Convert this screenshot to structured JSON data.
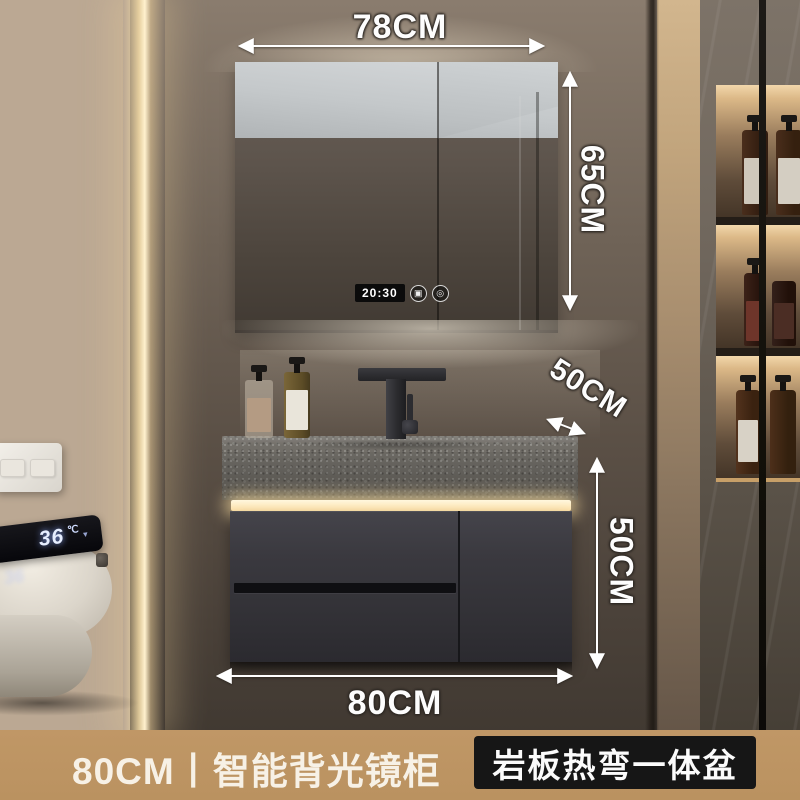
{
  "product_annotations": {
    "mirror_width": "78CM",
    "mirror_height": "65CM",
    "counter_depth": "50CM",
    "cabinet_height": "50CM",
    "cabinet_width": "80CM"
  },
  "mirror_display": {
    "time": "20:30",
    "defog_icon_glyph": "▣",
    "power_icon_glyph": "◎"
  },
  "toilet_display": {
    "temperature": "36",
    "unit": "℃",
    "chevron_glyph": "▾"
  },
  "banner": {
    "left_text": "80CM丨智能背光镜柜",
    "right_text": "岩板热弯一体盆",
    "bg_color": "#bd9563",
    "right_box_bg_color": "#161616",
    "text_color": "#f7f1e6"
  },
  "scene_colors": {
    "warm_backlight": "#f4dcae",
    "led_strip": "#ffe8b8",
    "cabinet": "#38373c",
    "countertop_stone": "#716e68",
    "display_glow_blue": "#e6eeff"
  }
}
